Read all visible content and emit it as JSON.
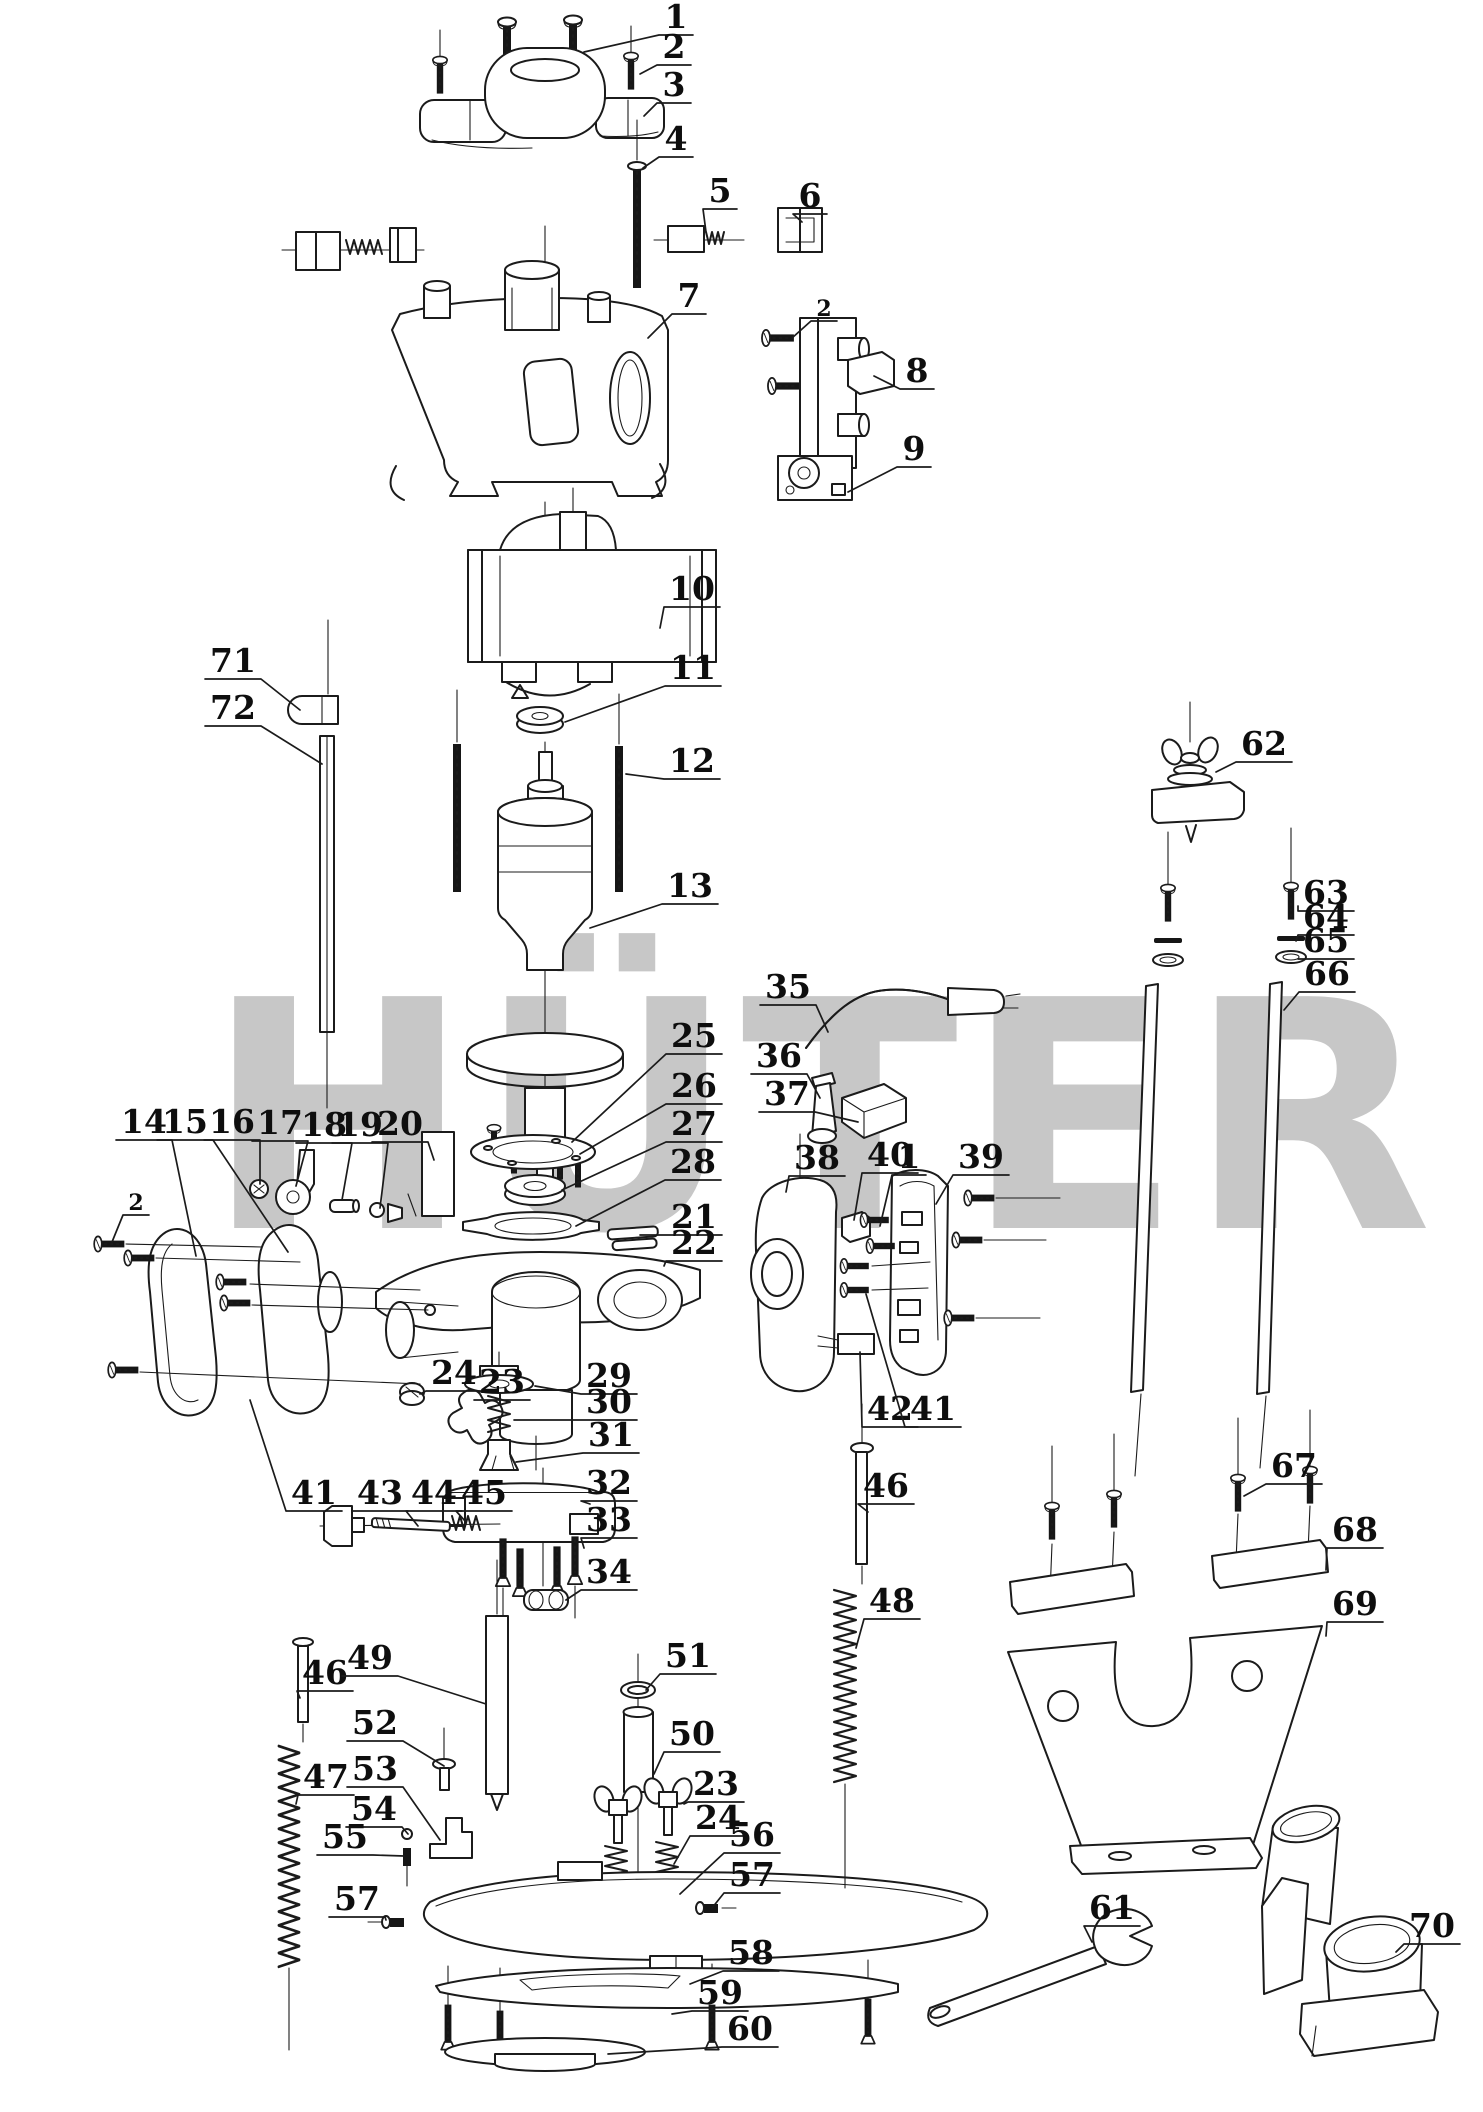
{
  "watermark": {
    "text": "HÜTER",
    "color": "#c7c7c7"
  },
  "logo": {
    "gray": "#c6c6c6",
    "red": "#ee8a8f",
    "yellow": "#f7f2ae"
  },
  "labels": [
    {
      "n": "1",
      "x": 676,
      "y": 16,
      "tx": 584,
      "ty": 52
    },
    {
      "n": "2",
      "x": 674,
      "y": 46,
      "tx": 640,
      "ty": 74
    },
    {
      "n": "3",
      "x": 674,
      "y": 84,
      "tx": 644,
      "ty": 116
    },
    {
      "n": "4",
      "x": 676,
      "y": 138,
      "tx": 643,
      "ty": 168
    },
    {
      "n": "5",
      "x": 720,
      "y": 190,
      "tx": 706,
      "ty": 232
    },
    {
      "n": "6",
      "x": 810,
      "y": 195,
      "tx": 802,
      "ty": 222
    },
    {
      "n": "7",
      "x": 689,
      "y": 295,
      "tx": 648,
      "ty": 338
    },
    {
      "n": "2",
      "x": 824,
      "y": 308,
      "tx": 792,
      "ty": 338,
      "small": true
    },
    {
      "n": "8",
      "x": 917,
      "y": 370,
      "tx": 874,
      "ty": 376
    },
    {
      "n": "9",
      "x": 914,
      "y": 448,
      "tx": 848,
      "ty": 492
    },
    {
      "n": "10",
      "x": 692,
      "y": 588,
      "tx": 660,
      "ty": 628
    },
    {
      "n": "11",
      "x": 693,
      "y": 667,
      "tx": 565,
      "ty": 722
    },
    {
      "n": "12",
      "x": 692,
      "y": 760,
      "tx": 626,
      "ty": 774
    },
    {
      "n": "13",
      "x": 690,
      "y": 885,
      "tx": 590,
      "ty": 928
    },
    {
      "n": "71",
      "x": 233,
      "y": 660,
      "tx": 300,
      "ty": 710
    },
    {
      "n": "72",
      "x": 233,
      "y": 707,
      "tx": 322,
      "ty": 764
    },
    {
      "n": "62",
      "x": 1264,
      "y": 743,
      "tx": 1216,
      "ty": 772
    },
    {
      "n": "63",
      "x": 1326,
      "y": 892,
      "tx": 1298,
      "ty": 906
    },
    {
      "n": "64",
      "x": 1326,
      "y": 916,
      "tx": 1296,
      "ty": 941
    },
    {
      "n": "65",
      "x": 1326,
      "y": 940,
      "tx": 1300,
      "ty": 959
    },
    {
      "n": "66",
      "x": 1327,
      "y": 973,
      "tx": 1284,
      "ty": 1010
    },
    {
      "n": "35",
      "x": 788,
      "y": 986,
      "tx": 828,
      "ty": 1032
    },
    {
      "n": "36",
      "x": 779,
      "y": 1055,
      "tx": 820,
      "ty": 1098
    },
    {
      "n": "37",
      "x": 787,
      "y": 1093,
      "tx": 858,
      "ty": 1122
    },
    {
      "n": "25",
      "x": 694,
      "y": 1035,
      "tx": 572,
      "ty": 1142
    },
    {
      "n": "26",
      "x": 694,
      "y": 1085,
      "tx": 580,
      "ty": 1154
    },
    {
      "n": "27",
      "x": 694,
      "y": 1123,
      "tx": 562,
      "ty": 1190
    },
    {
      "n": "28",
      "x": 693,
      "y": 1161,
      "tx": 576,
      "ty": 1226
    },
    {
      "n": "21",
      "x": 694,
      "y": 1216,
      "tx": 640,
      "ty": 1235
    },
    {
      "n": "22",
      "x": 694,
      "y": 1242,
      "tx": 664,
      "ty": 1266
    },
    {
      "n": "14",
      "x": 144,
      "y": 1121,
      "tx": 196,
      "ty": 1256
    },
    {
      "n": "15",
      "x": 185,
      "y": 1121,
      "tx": 288,
      "ty": 1252
    },
    {
      "n": "16",
      "x": 232,
      "y": 1121,
      "tx": 260,
      "ty": 1184
    },
    {
      "n": "17",
      "x": 280,
      "y": 1122,
      "tx": 296,
      "ty": 1186
    },
    {
      "n": "18",
      "x": 324,
      "y": 1124,
      "tx": 342,
      "ty": 1200
    },
    {
      "n": "19",
      "x": 360,
      "y": 1124,
      "tx": 380,
      "ty": 1208
    },
    {
      "n": "20",
      "x": 400,
      "y": 1123,
      "tx": 434,
      "ty": 1160
    },
    {
      "n": "2",
      "x": 136,
      "y": 1202,
      "tx": 112,
      "ty": 1242,
      "small": true
    },
    {
      "n": "24",
      "x": 454,
      "y": 1372,
      "tx": 420,
      "ty": 1394
    },
    {
      "n": "23",
      "x": 502,
      "y": 1381,
      "tx": 482,
      "ty": 1400
    },
    {
      "n": "29",
      "x": 609,
      "y": 1375,
      "tx": 535,
      "ty": 1386
    },
    {
      "n": "30",
      "x": 609,
      "y": 1401,
      "tx": 514,
      "ty": 1420
    },
    {
      "n": "31",
      "x": 611,
      "y": 1434,
      "tx": 516,
      "ty": 1462
    },
    {
      "n": "32",
      "x": 609,
      "y": 1482,
      "tx": 590,
      "ty": 1504
    },
    {
      "n": "33",
      "x": 609,
      "y": 1519,
      "tx": 584,
      "ty": 1548
    },
    {
      "n": "34",
      "x": 609,
      "y": 1571,
      "tx": 566,
      "ty": 1600
    },
    {
      "n": "41",
      "x": 314,
      "y": 1492,
      "tx": 250,
      "ty": 1400
    },
    {
      "n": "43",
      "x": 380,
      "y": 1492,
      "tx": 352,
      "ty": 1516
    },
    {
      "n": "44",
      "x": 434,
      "y": 1492,
      "tx": 418,
      "ty": 1526
    },
    {
      "n": "45",
      "x": 484,
      "y": 1492,
      "tx": 466,
      "ty": 1522
    },
    {
      "n": "38",
      "x": 817,
      "y": 1157,
      "tx": 786,
      "ty": 1192
    },
    {
      "n": "40",
      "x": 890,
      "y": 1154,
      "tx": 854,
      "ty": 1220
    },
    {
      "n": "1",
      "x": 909,
      "y": 1156,
      "tx": 880,
      "ty": 1226
    },
    {
      "n": "39",
      "x": 981,
      "y": 1156,
      "tx": 936,
      "ty": 1204
    },
    {
      "n": "42",
      "x": 890,
      "y": 1408,
      "tx": 860,
      "ty": 1352
    },
    {
      "n": "41",
      "x": 933,
      "y": 1408,
      "tx": 866,
      "ty": 1294
    },
    {
      "n": "46",
      "x": 325,
      "y": 1672,
      "tx": 300,
      "ty": 1698
    },
    {
      "n": "47",
      "x": 326,
      "y": 1776,
      "tx": 296,
      "ty": 1804
    },
    {
      "n": "49",
      "x": 370,
      "y": 1657,
      "tx": 486,
      "ty": 1704
    },
    {
      "n": "52",
      "x": 375,
      "y": 1722,
      "tx": 444,
      "ty": 1766
    },
    {
      "n": "53",
      "x": 375,
      "y": 1768,
      "tx": 440,
      "ty": 1840
    },
    {
      "n": "54",
      "x": 374,
      "y": 1808,
      "tx": 408,
      "ty": 1834
    },
    {
      "n": "55",
      "x": 345,
      "y": 1836,
      "tx": 404,
      "ty": 1856
    },
    {
      "n": "57",
      "x": 357,
      "y": 1898,
      "tx": 386,
      "ty": 1920
    },
    {
      "n": "51",
      "x": 688,
      "y": 1655,
      "tx": 646,
      "ty": 1690
    },
    {
      "n": "50",
      "x": 692,
      "y": 1733,
      "tx": 654,
      "ty": 1774
    },
    {
      "n": "23",
      "x": 716,
      "y": 1783,
      "tx": 684,
      "ty": 1804
    },
    {
      "n": "24",
      "x": 718,
      "y": 1817,
      "tx": 674,
      "ty": 1864
    },
    {
      "n": "56",
      "x": 752,
      "y": 1834,
      "tx": 680,
      "ty": 1894
    },
    {
      "n": "57",
      "x": 752,
      "y": 1874,
      "tx": 712,
      "ty": 1908
    },
    {
      "n": "58",
      "x": 751,
      "y": 1952,
      "tx": 690,
      "ty": 1984
    },
    {
      "n": "59",
      "x": 720,
      "y": 1992,
      "tx": 672,
      "ty": 2014
    },
    {
      "n": "60",
      "x": 750,
      "y": 2028,
      "tx": 608,
      "ty": 2054
    },
    {
      "n": "46",
      "x": 886,
      "y": 1485,
      "tx": 868,
      "ty": 1512
    },
    {
      "n": "48",
      "x": 892,
      "y": 1600,
      "tx": 856,
      "ty": 1648
    },
    {
      "n": "67",
      "x": 1294,
      "y": 1465,
      "tx": 1244,
      "ty": 1496
    },
    {
      "n": "68",
      "x": 1355,
      "y": 1529,
      "tx": 1326,
      "ty": 1570
    },
    {
      "n": "69",
      "x": 1355,
      "y": 1603,
      "tx": 1326,
      "ty": 1636
    },
    {
      "n": "61",
      "x": 1112,
      "y": 1907,
      "tx": 1092,
      "ty": 1942
    },
    {
      "n": "70",
      "x": 1432,
      "y": 1925,
      "tx": 1396,
      "ty": 1952
    }
  ]
}
